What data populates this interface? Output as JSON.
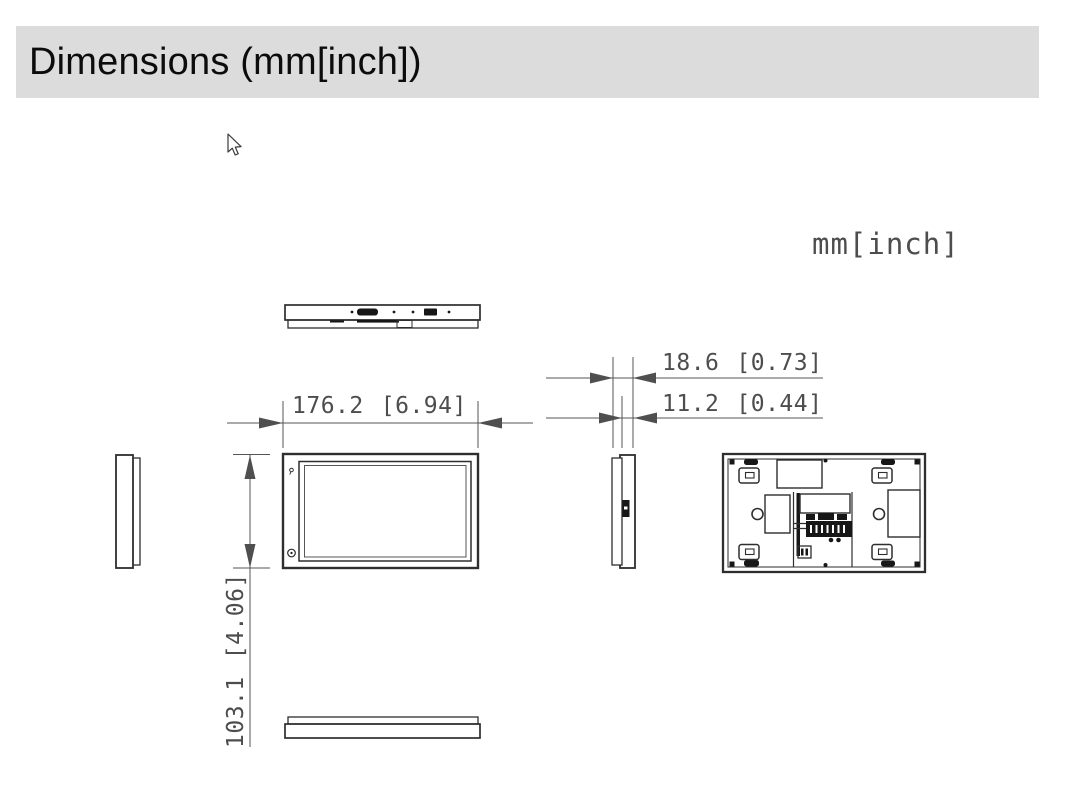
{
  "header": {
    "title": "Dimensions (mm[inch])"
  },
  "canvas": {
    "units_label": "mm[inch]"
  },
  "dimension_labels": {
    "width": {
      "mm": "176.2",
      "inch": "[6.94]"
    },
    "depth_total": {
      "mm": "18.6",
      "inch": "[0.73]"
    },
    "depth_front": {
      "mm": "11.2",
      "inch": "[0.44]"
    },
    "height": {
      "mm": "103.1",
      "inch": "[4.06]"
    }
  },
  "colors": {
    "header_bg": "#dcdcdc",
    "header_text": "#0c0c0c",
    "drawing_line": "#2e2e2e",
    "dimension_text": "#4d4d4d",
    "background": "#ffffff"
  }
}
